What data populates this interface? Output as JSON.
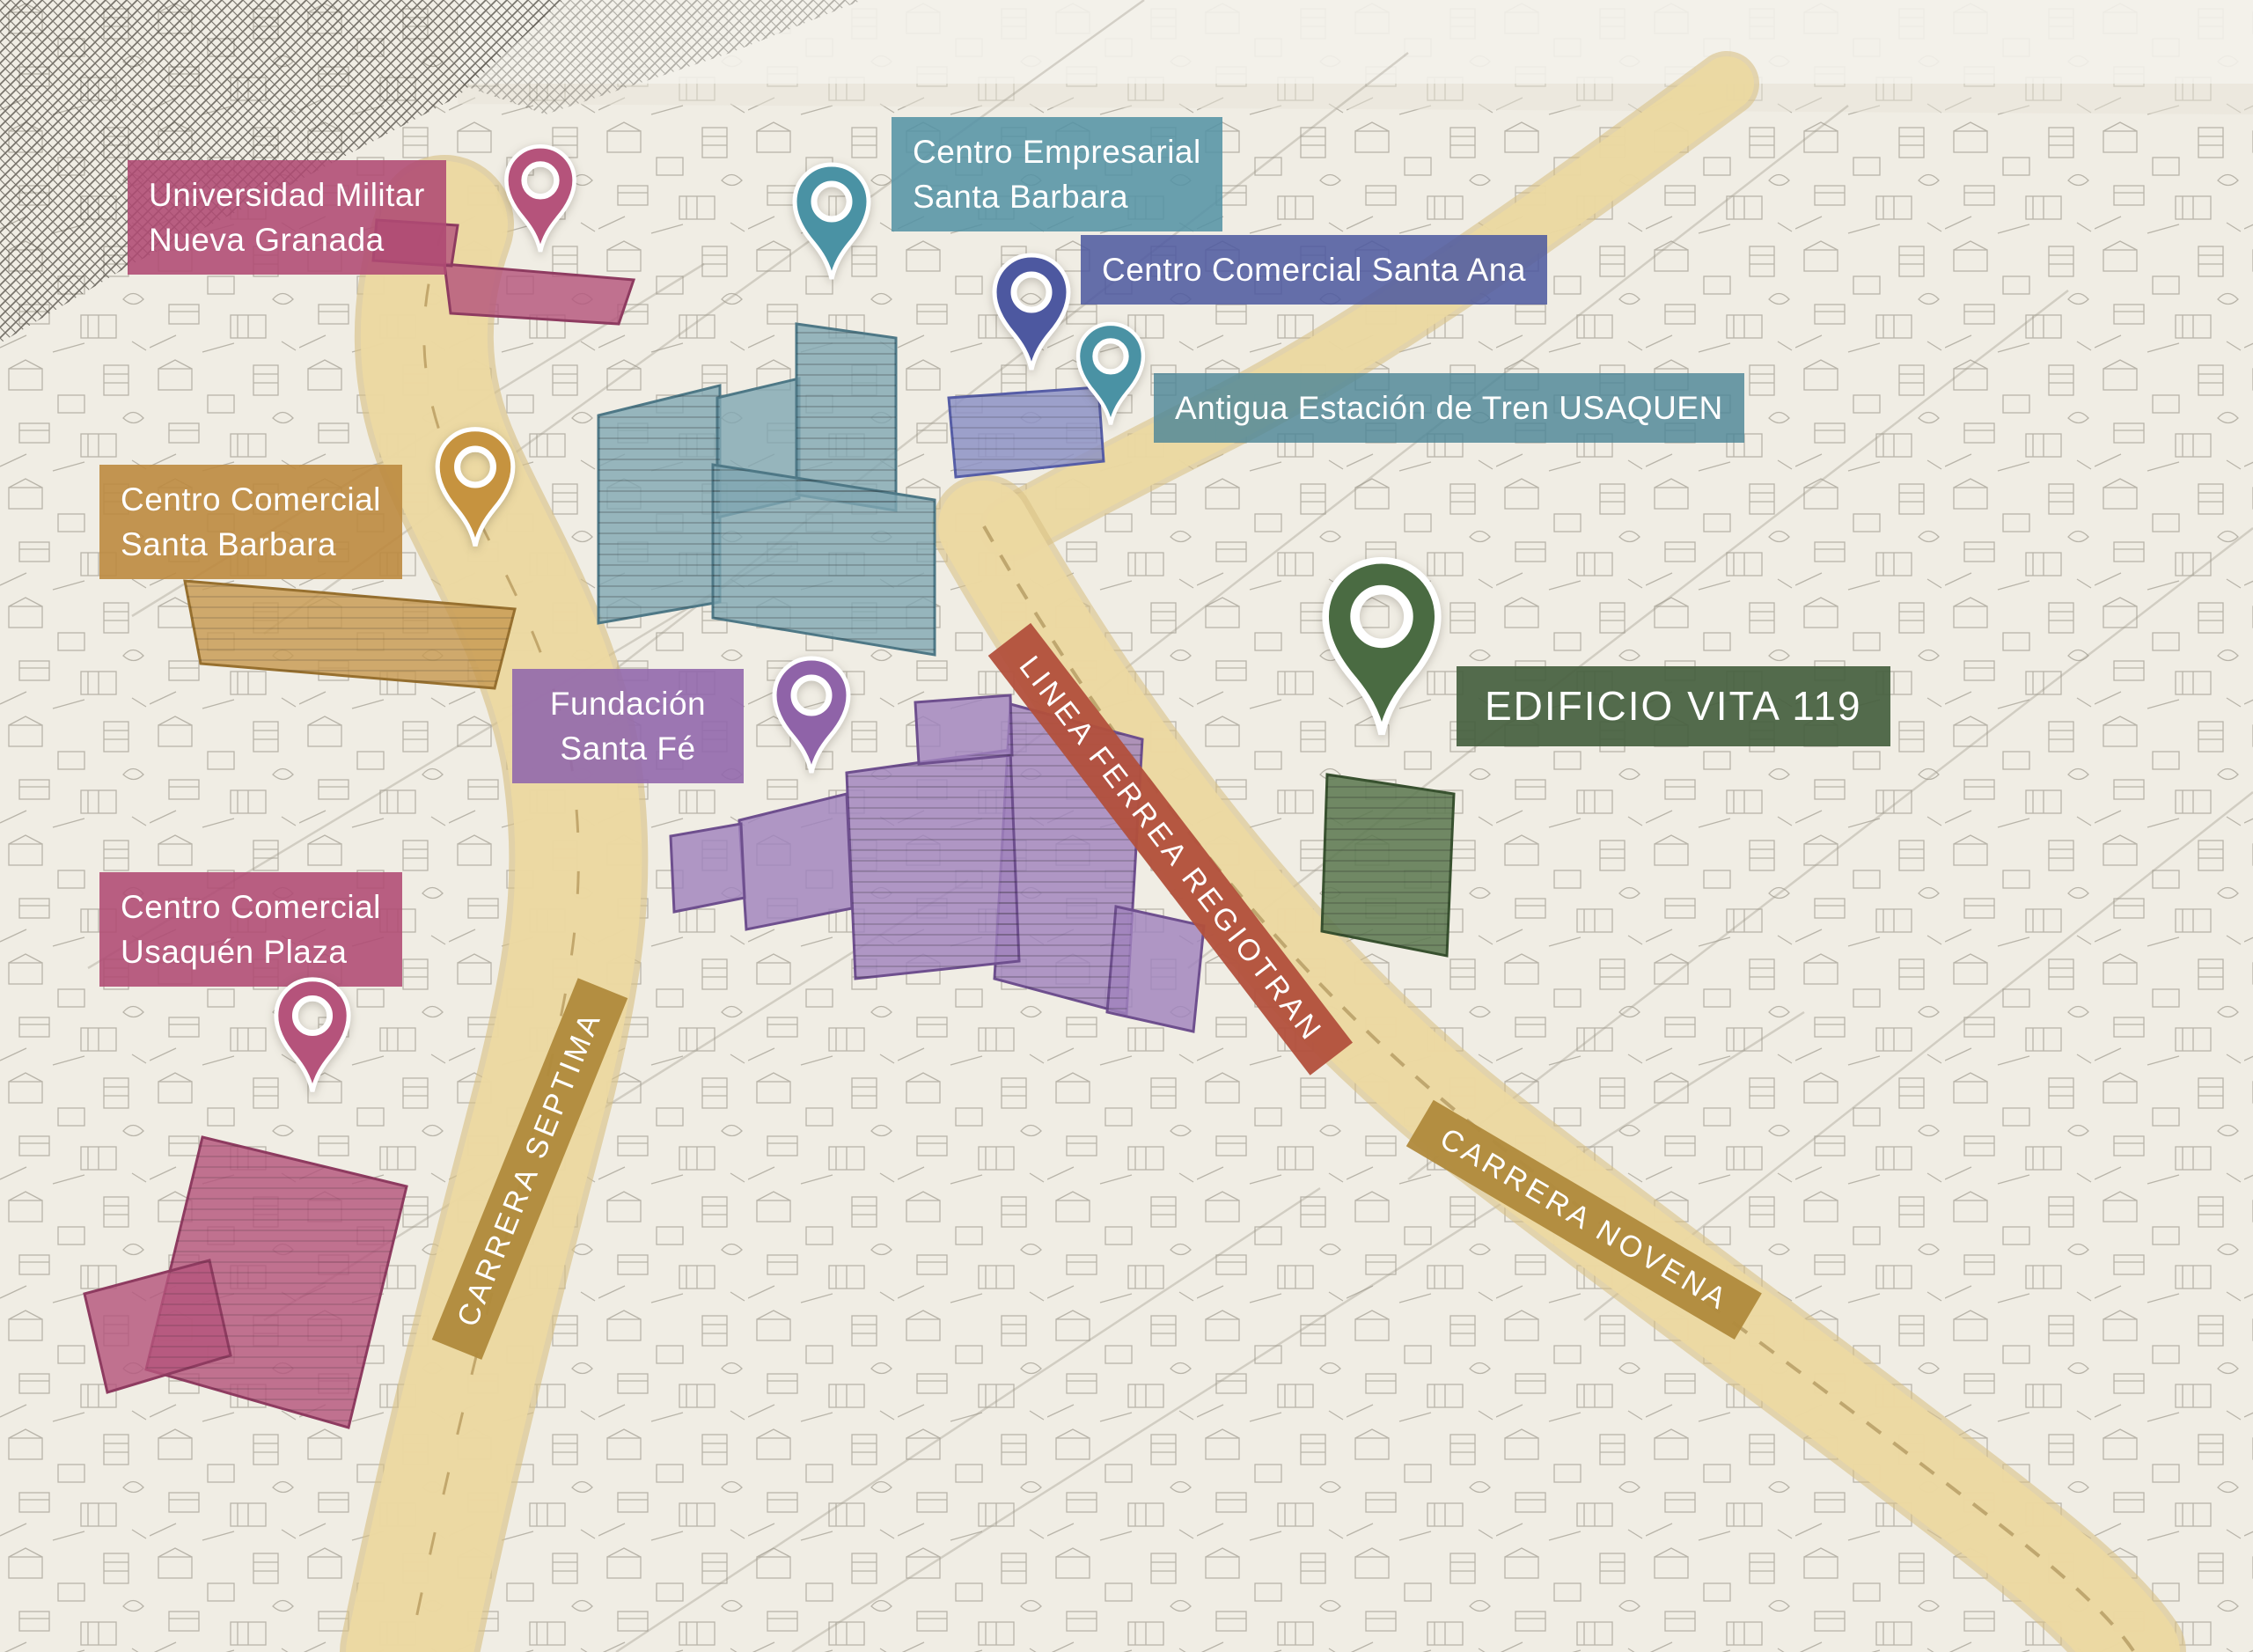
{
  "map_title": "Illustrated aerial map of Usaquén / Santa Barbara district",
  "landmarks": [
    {
      "id": "universidad-militar",
      "name": "Universidad Militar\nNueva Granada",
      "label_color": "#af4a73",
      "pin": true
    },
    {
      "id": "centro-empresarial-santa-barbara",
      "name": "Centro Empresarial\nSanta Barbara",
      "label_color": "#5392a4",
      "pin": true
    },
    {
      "id": "centro-comercial-santa-ana",
      "name": "Centro Comercial Santa Ana",
      "label_color": "#4d58a0",
      "pin": true
    },
    {
      "id": "antigua-estacion-tren-usaquen",
      "name": "Antigua Estación de Tren USAQUEN",
      "label_color": "#4d8697",
      "pin": true
    },
    {
      "id": "centro-comercial-santa-barbara",
      "name": "Centro Comercial\nSanta Barbara",
      "label_color": "#bd8a3f",
      "pin": true
    },
    {
      "id": "fundacion-santa-fe",
      "name": "Fundación\nSanta Fé",
      "label_color": "#9268ac",
      "pin": true
    },
    {
      "id": "edificio-vita-119",
      "name": "EDIFICIO VITA 119",
      "label_color": "#45603f",
      "pin": true
    },
    {
      "id": "centro-comercial-usaquen-plaza",
      "name": "Centro Comercial\nUsaquén Plaza",
      "label_color": "#af4a73",
      "pin": true
    }
  ],
  "roads": [
    {
      "id": "carrera-septima",
      "name": "CARRERA SEPTIMA",
      "banner_color": "#b08a3c"
    },
    {
      "id": "linea-ferrea-regiotran",
      "name": "LINEA FERREA REGIOTRAN",
      "banner_color": "#b2503c"
    },
    {
      "id": "carrera-novena",
      "name": "CARRERA NOVENA",
      "banner_color": "#b08a3c"
    }
  ],
  "palette": {
    "paper": "#f0ede4",
    "road_fill": "#ecd9a2",
    "teal_building": "#7fa6b2",
    "indigo_building": "#8d92c6",
    "purple_building": "#a083bd",
    "green_building": "#5d7a52",
    "pink_building": "#b5567d",
    "orange_building": "#c79a52",
    "ink": "#3f3c35"
  }
}
